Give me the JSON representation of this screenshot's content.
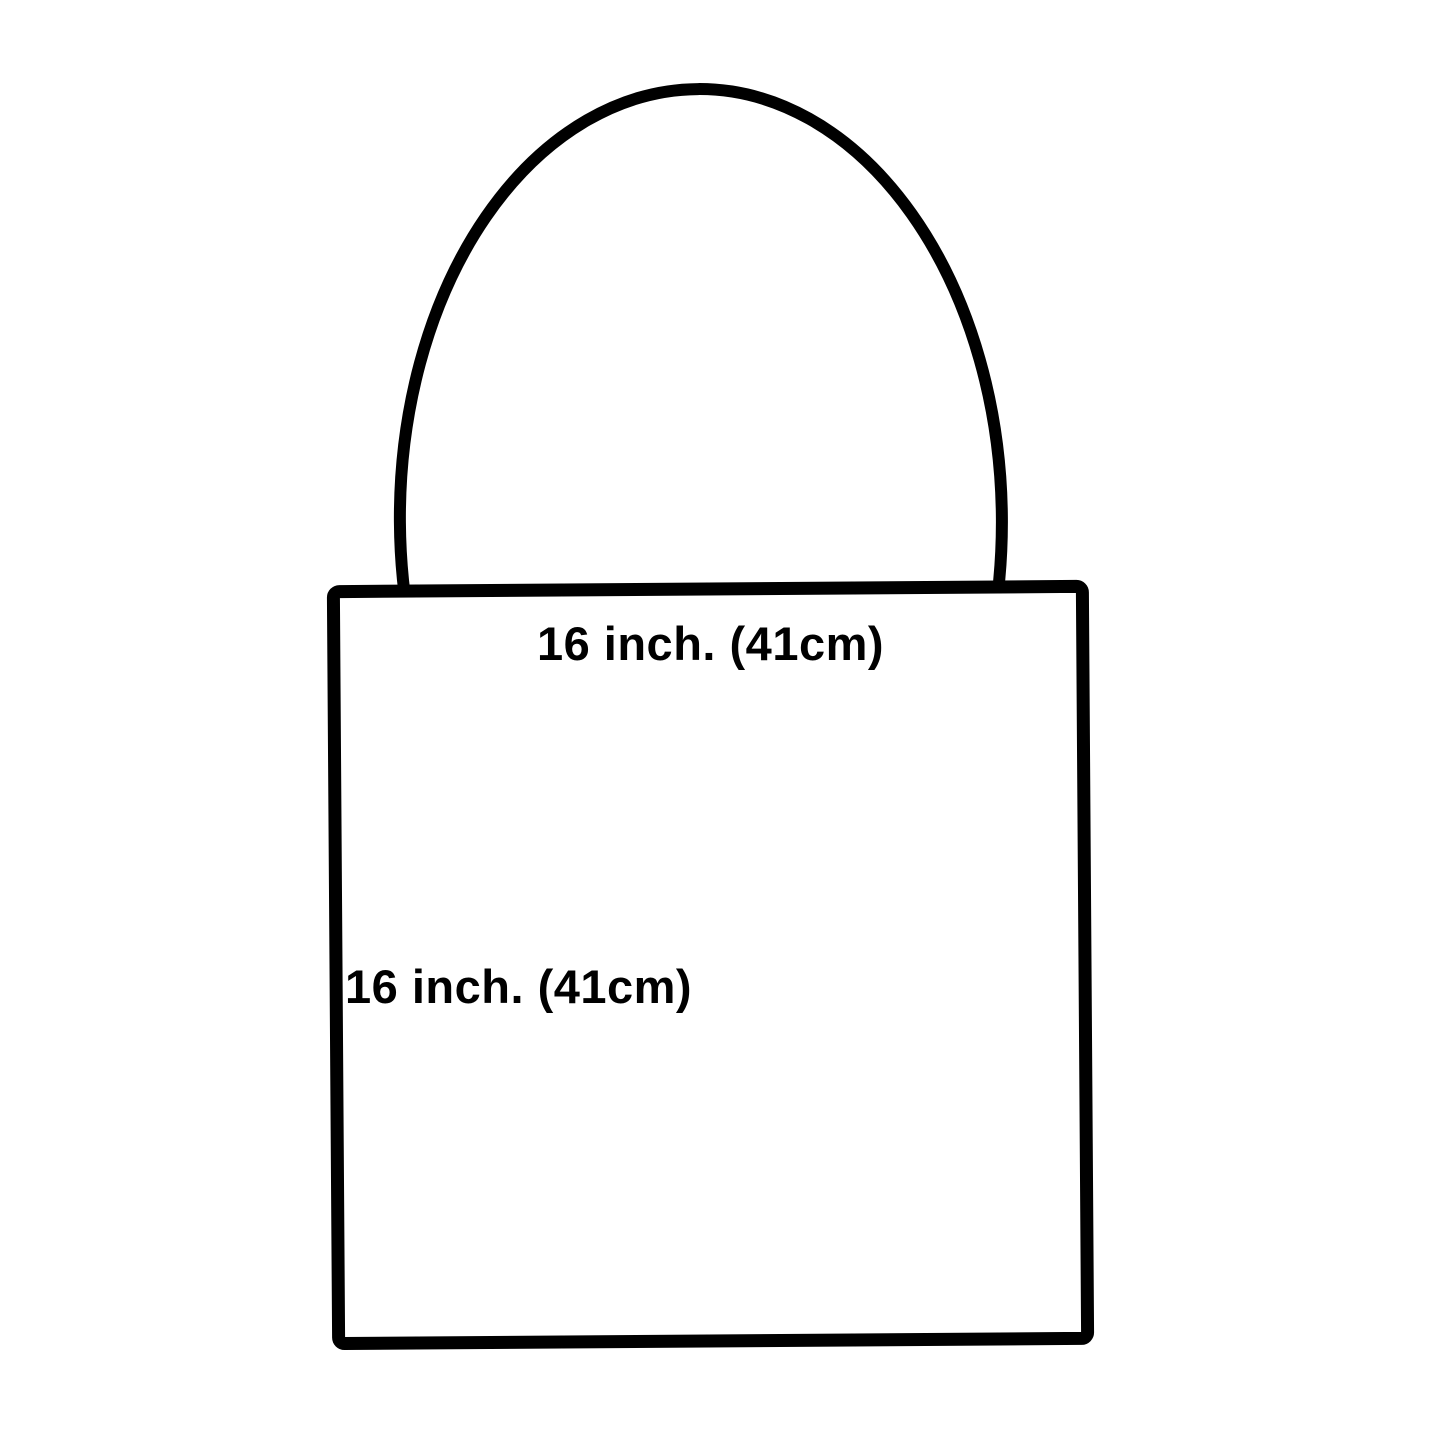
{
  "canvas": {
    "background": "#ffffff",
    "line_color": "#000000",
    "text_color": "#000000"
  },
  "diagram": {
    "subject": "tote-bag-outline",
    "width_label": "16 inch. (41cm)",
    "height_label": "16 inch. (41cm)"
  }
}
